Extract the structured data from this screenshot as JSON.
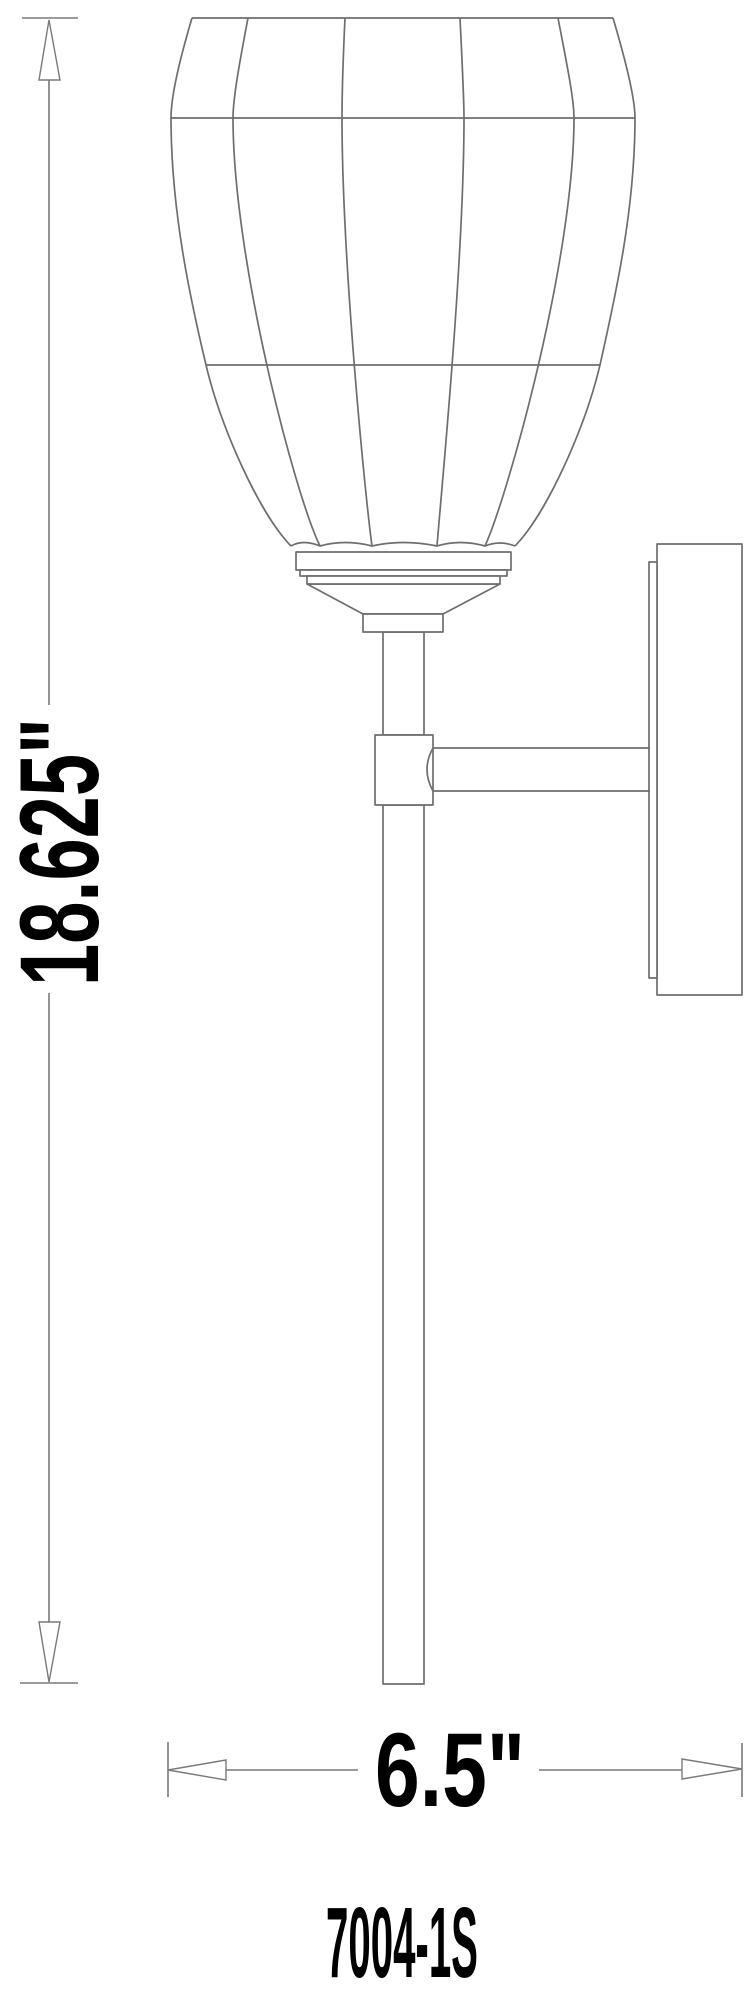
{
  "diagram": {
    "title": "wall sconce dimension drawing",
    "height_label": "18.625\"",
    "width_label": "6.5\"",
    "model_number": "7004-1S"
  },
  "style": {
    "line_color": "#6e6e6e",
    "dim_line_color": "#7a7a7a",
    "text_color": "#000000",
    "background_color": "#ffffff"
  }
}
